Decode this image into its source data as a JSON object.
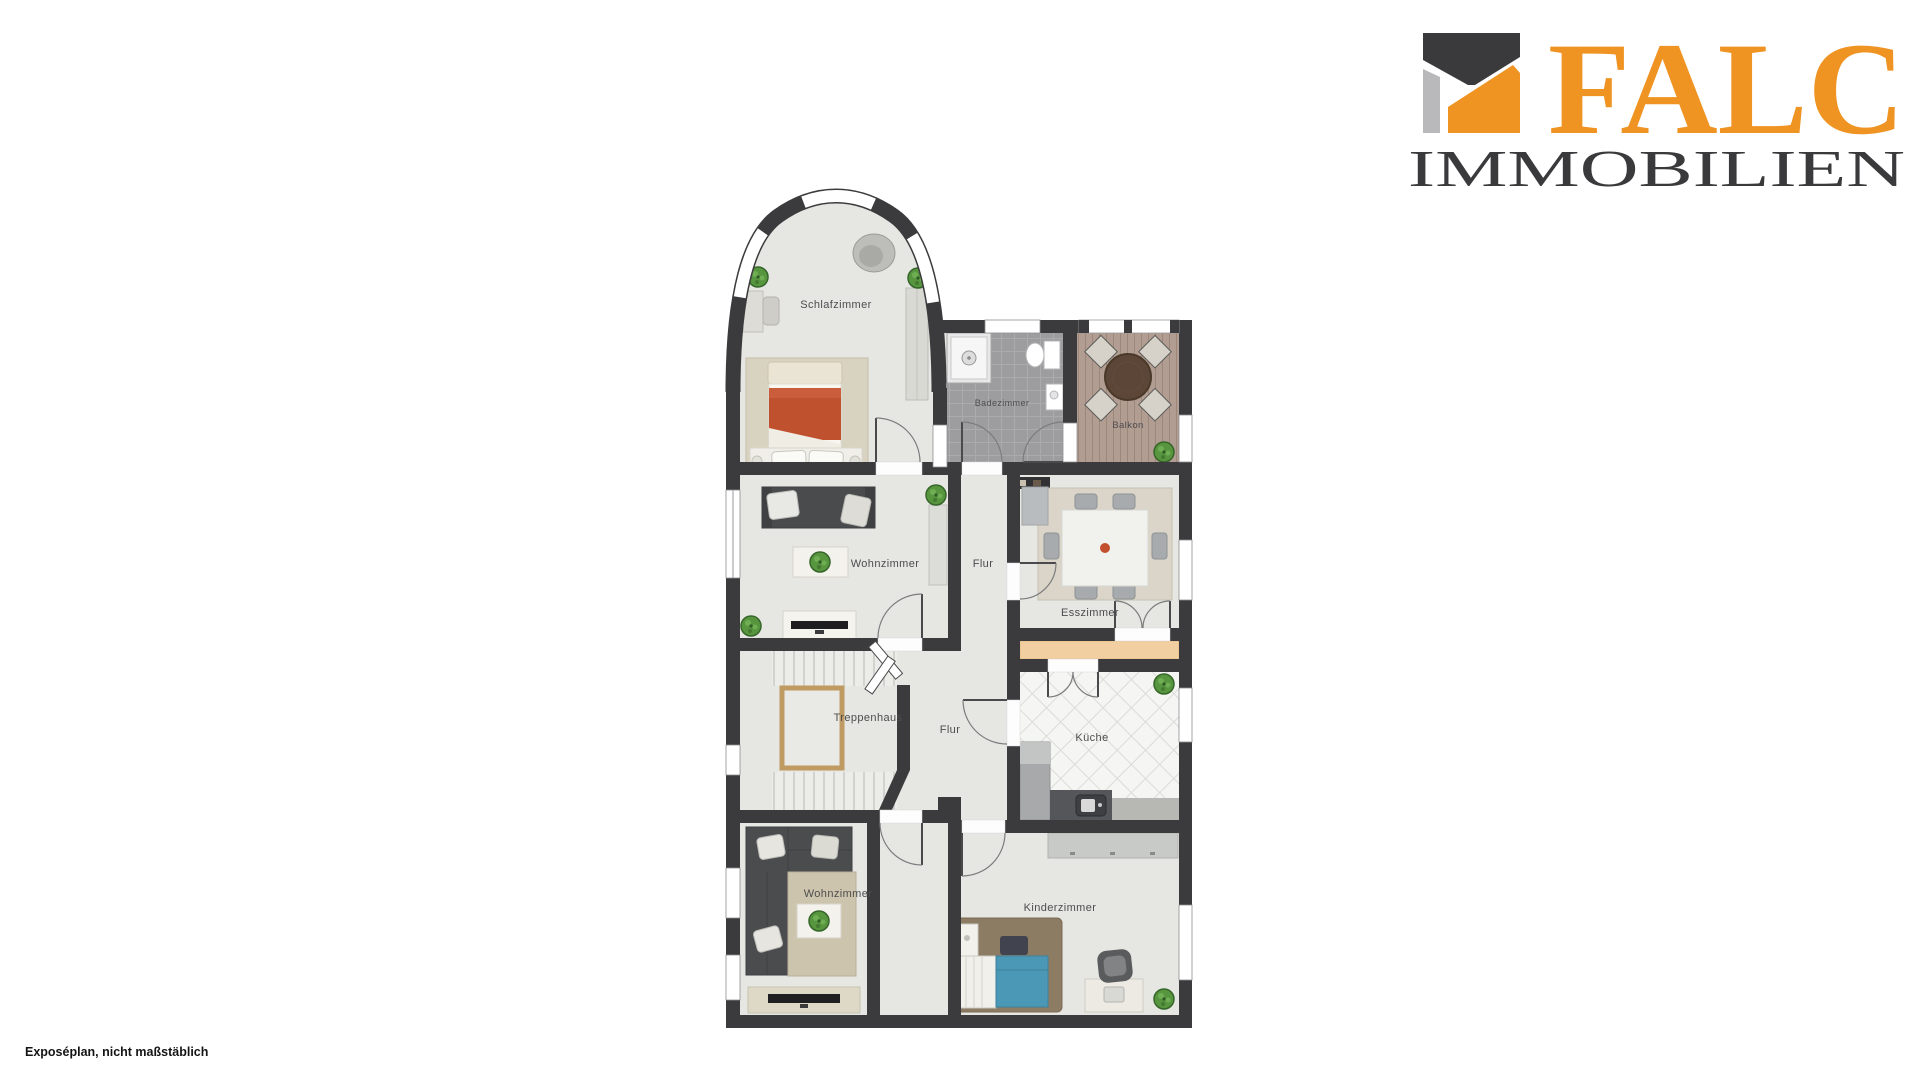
{
  "page": {
    "background": "#ffffff"
  },
  "logo": {
    "brand": "FALC",
    "subtitle": "IMMOBILIEN",
    "brand_color": "#ef9322",
    "subtitle_color": "#3a3a3c",
    "mark_colors": {
      "dark": "#3a3a3c",
      "gray": "#b9b9bb",
      "orange": "#ef9322"
    }
  },
  "caption": {
    "text": "Exposéplan, nicht maßstäblich"
  },
  "floorplan": {
    "rooms": [
      {
        "id": "schlafzimmer",
        "label": "Schlafzimmer"
      },
      {
        "id": "badezimmer",
        "label": "Badezimmer"
      },
      {
        "id": "balkon",
        "label": "Balkon"
      },
      {
        "id": "wohnzimmer-oben",
        "label": "Wohnzimmer"
      },
      {
        "id": "flur-oben",
        "label": "Flur"
      },
      {
        "id": "esszimmer",
        "label": "Esszimmer"
      },
      {
        "id": "treppenhaus",
        "label": "Treppenhaus"
      },
      {
        "id": "flur-unten",
        "label": "Flur"
      },
      {
        "id": "kueche",
        "label": "Küche"
      },
      {
        "id": "wohnzimmer-unten",
        "label": "Wohnzimmer"
      },
      {
        "id": "kinderzimmer",
        "label": "Kinderzimmer"
      }
    ],
    "colors": {
      "wall": "#3b3b3d",
      "floor": "#e6e6e2",
      "bath_tile": "#9d9da0",
      "balcony_wood": "#b19d91",
      "kitchen_tile": "#f5f5f3",
      "accent_tan": "#f2cfa0",
      "stair_rail": "#bf9a62",
      "bed_red": "#c0512f",
      "kids_blue": "#4a98b5",
      "sofa_dark": "#4a4b4d",
      "plant_green": "#57963f"
    }
  }
}
